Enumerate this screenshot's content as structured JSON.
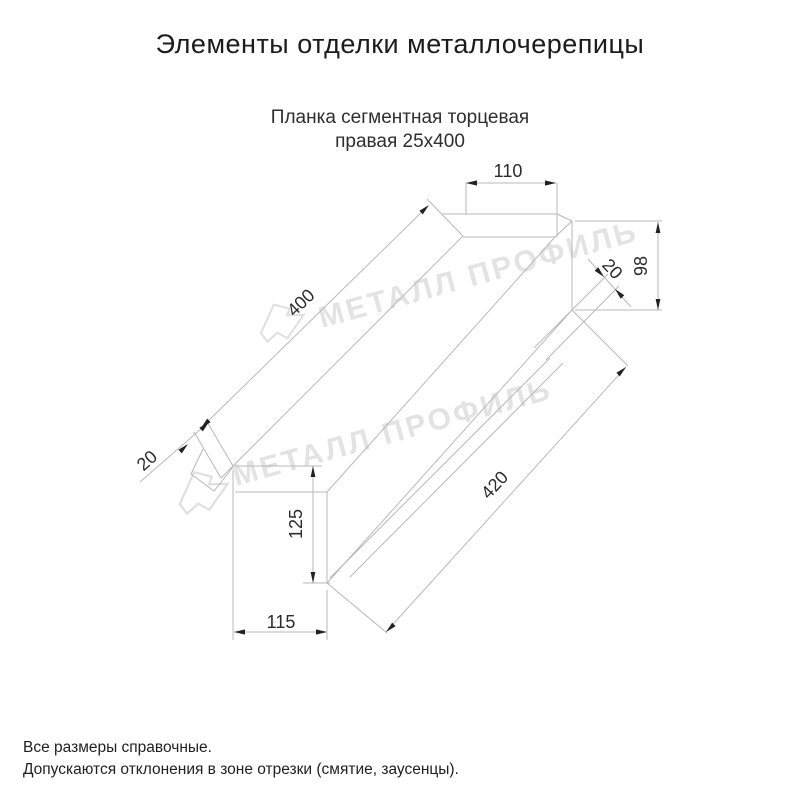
{
  "page": {
    "title": "Элементы отделки металлочерепицы",
    "product": {
      "subtitle_line1": "Планка сегментная торцевая",
      "subtitle_line2": "правая 25х400"
    },
    "notes": {
      "line1": "Все размеры справочные.",
      "line2": "Допускаются отклонения в зоне отрезки (смятие, заусенцы)."
    }
  },
  "drawing": {
    "watermark_text": "МЕТАЛЛ ПРОФИЛЬ",
    "dimensions": {
      "top_flange_width": "110",
      "end_height": "98",
      "end_hem": "20",
      "top_edge_length": "400",
      "left_hem": "20",
      "left_end_drop": "125",
      "bottom_end_offset": "115",
      "bottom_edge_length": "420"
    },
    "colors": {
      "line": "#b9b9b9",
      "annotation": "#2b2b2b",
      "watermark": "#e3e3e3",
      "background": "#ffffff"
    }
  }
}
